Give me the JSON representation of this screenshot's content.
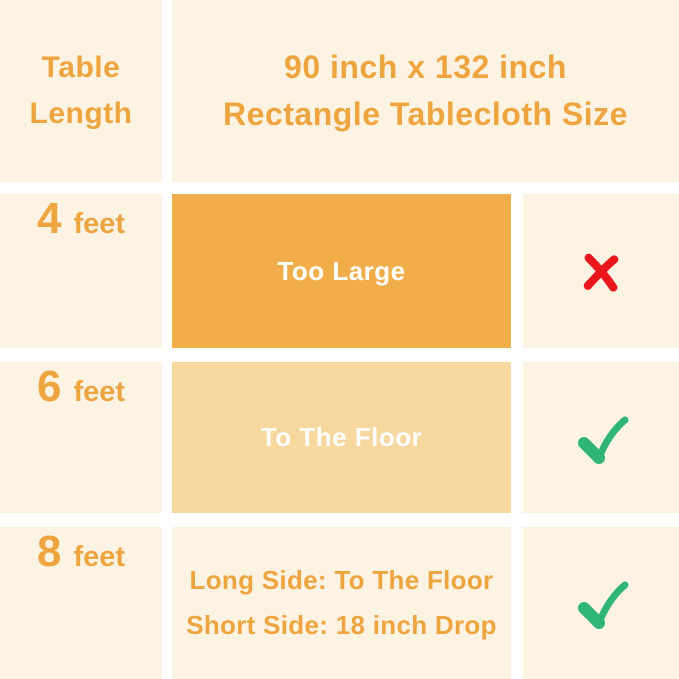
{
  "header": {
    "row_label_line1": "Table",
    "row_label_line2": "Length",
    "title_line1": "90 inch x 132 inch",
    "title_line2": "Rectangle Tablecloth Size"
  },
  "rows": [
    {
      "length_value": "4",
      "length_unit": "feet",
      "fit_text": "Too Large",
      "verdict": "no"
    },
    {
      "length_value": "6",
      "length_unit": "feet",
      "fit_text": "To The Floor",
      "verdict": "yes"
    },
    {
      "length_value": "8",
      "length_unit": "feet",
      "fit_text_line1": "Long Side: To The Floor",
      "fit_text_line2": "Short Side: 18 inch Drop",
      "verdict": "yes"
    }
  ],
  "icons": {
    "no": "x-mark-icon",
    "yes": "check-mark-icon"
  },
  "colors": {
    "background_cream": "#FDF3E3",
    "divider_white": "#FFFFFF",
    "text_orange": "#EEA53F",
    "box_solid_orange": "#F1AD49",
    "box_light_orange": "#F7D89F",
    "box_text_white": "#FFFFFF",
    "cross_red": "#E9161B",
    "check_green": "#2FB574"
  },
  "chart_data": {
    "type": "table",
    "title": "90 inch x 132 inch Rectangle Tablecloth Size",
    "columns": [
      "Table Length",
      "90 inch x 132 inch Rectangle Tablecloth Size"
    ],
    "rows": [
      [
        "4 feet",
        "Too Large",
        "no"
      ],
      [
        "6 feet",
        "To The Floor",
        "yes"
      ],
      [
        "8 feet",
        "Long Side: To The Floor / Short Side: 18 inch Drop",
        "yes"
      ]
    ],
    "legend_position": "none",
    "grid": "white dividers between cream cells"
  }
}
